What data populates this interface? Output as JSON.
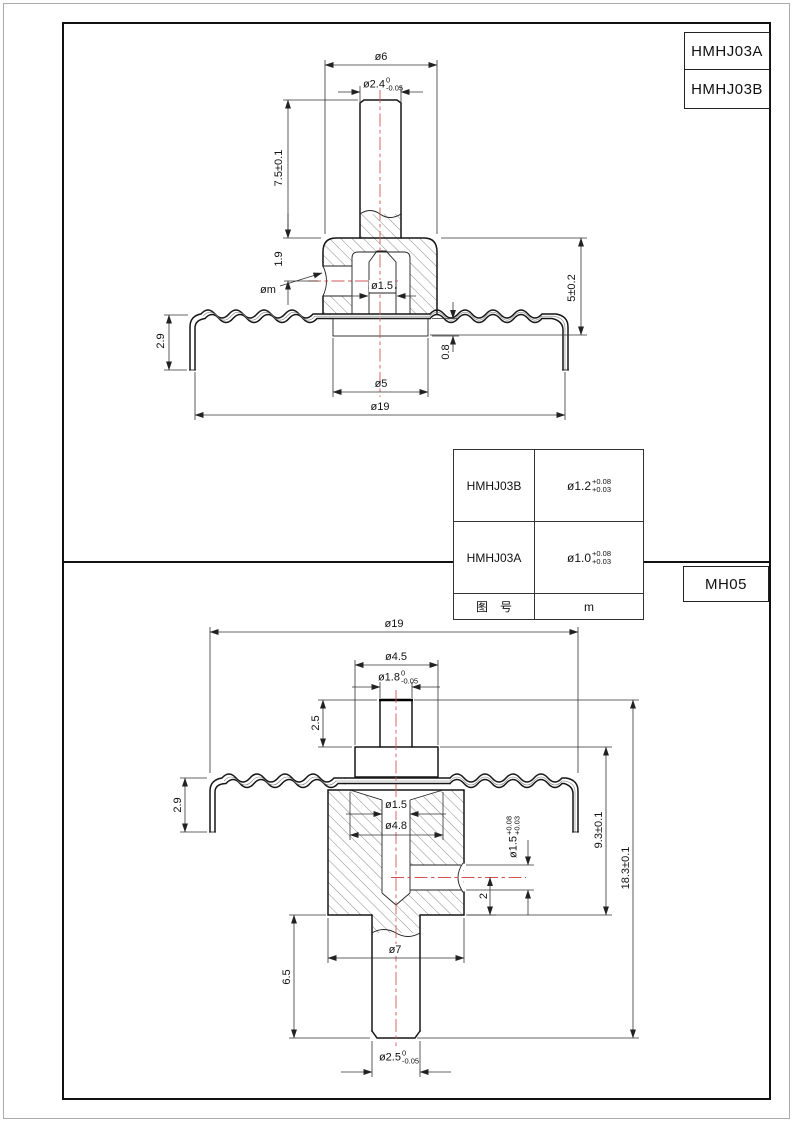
{
  "titles": {
    "top_a": "HMHJ03A",
    "top_b": "HMHJ03B",
    "bottom": "MH05"
  },
  "colors": {
    "centerline": "#d05454",
    "outline": "#161616"
  },
  "top_drawing": {
    "dia6": "ø6",
    "dia2_4": {
      "main": "ø2.4",
      "up": "0",
      "dn": "-0.05"
    },
    "len7_5": "7.5±0.1",
    "len1_9": "1.9",
    "dia_m": "øm",
    "dia1_5": "ø1.5",
    "len5": "5±0.2",
    "len2_9": "2.9",
    "len0_8": "0.8",
    "dia5": "ø5",
    "dia19": "ø19"
  },
  "spec_table": {
    "rows": [
      {
        "model": "HMHJ03B",
        "dia": {
          "main": "ø1.2",
          "up": "+0.08",
          "dn": "+0.03"
        }
      },
      {
        "model": "HMHJ03A",
        "dia": {
          "main": "ø1.0",
          "up": "+0.08",
          "dn": "+0.03"
        }
      },
      {
        "model": "图　号",
        "dia": {
          "main": "m",
          "up": "",
          "dn": ""
        }
      }
    ]
  },
  "bottom_drawing": {
    "dia19": "ø19",
    "dia4_5": "ø4.5",
    "dia1_8": {
      "main": "ø1.8",
      "up": "0",
      "dn": "-0.05"
    },
    "len2_5": "2.5",
    "len2_9": "2.9",
    "dia1_5": "ø1.5",
    "dia4_8": "ø4.8",
    "dia1_5tol": {
      "main": "ø1.5",
      "up": "+0.08",
      "dn": "+0.03"
    },
    "len2": "2",
    "len9_3": "9.3±0.1",
    "len18_3": "18.3±0.1",
    "dia7": "ø7",
    "len6_5": "6.5",
    "dia2_5": {
      "main": "ø2.5",
      "up": "0",
      "dn": "-0.05"
    }
  }
}
